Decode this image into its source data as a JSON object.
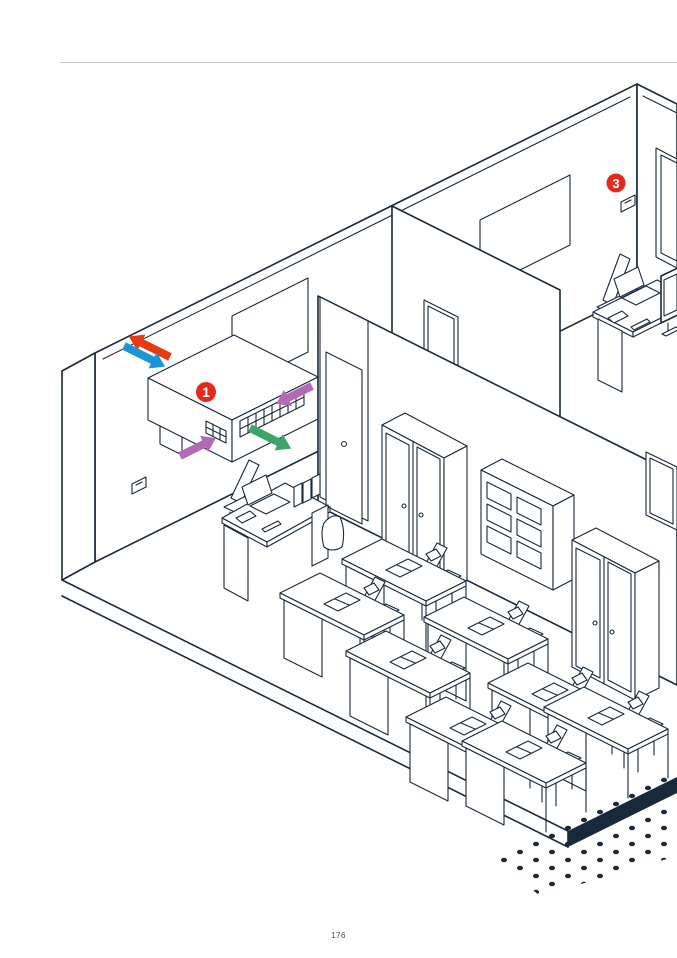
{
  "page": {
    "number": "176"
  },
  "illustration": {
    "type": "isometric-cutaway-building",
    "description_elements": [
      "classroom",
      "office",
      "corridor-doors",
      "floor-slab",
      "halftone-dots"
    ],
    "line_color": "#19283a",
    "rule_color": "#c9c9c9",
    "markers": [
      {
        "label": "1",
        "color": "#e42a1c",
        "target": "ventilation-unit"
      },
      {
        "label": "3",
        "color": "#e42a1c",
        "target": "wall-controller"
      }
    ],
    "airflow_arrows": [
      {
        "name": "exhaust-air-to-outside",
        "color": "#e8390f",
        "direction": "up-left"
      },
      {
        "name": "outdoor-air-intake",
        "color": "#1996d7",
        "direction": "down-right"
      },
      {
        "name": "extract-air-rear",
        "color": "#b469b4",
        "direction": "down-left"
      },
      {
        "name": "extract-air-front",
        "color": "#b469b4",
        "direction": "up-right"
      },
      {
        "name": "supply-air-to-room",
        "color": "#3ca569",
        "direction": "down-right"
      }
    ],
    "rooms": [
      {
        "name": "classroom",
        "furniture": [
          "teacher-desk",
          "wardrobe",
          "open-shelf",
          "wardrobe",
          "student-desks"
        ]
      },
      {
        "name": "office",
        "furniture": [
          "office-desk",
          "monitor",
          "window",
          "whiteboard"
        ]
      }
    ],
    "student_desk_count": 8,
    "student_desk_positions": [
      [
        342,
        604
      ],
      [
        404,
        570
      ],
      [
        408,
        662
      ],
      [
        486,
        628
      ],
      [
        468,
        728
      ],
      [
        550,
        694
      ],
      [
        524,
        752
      ],
      [
        606,
        718
      ]
    ]
  }
}
